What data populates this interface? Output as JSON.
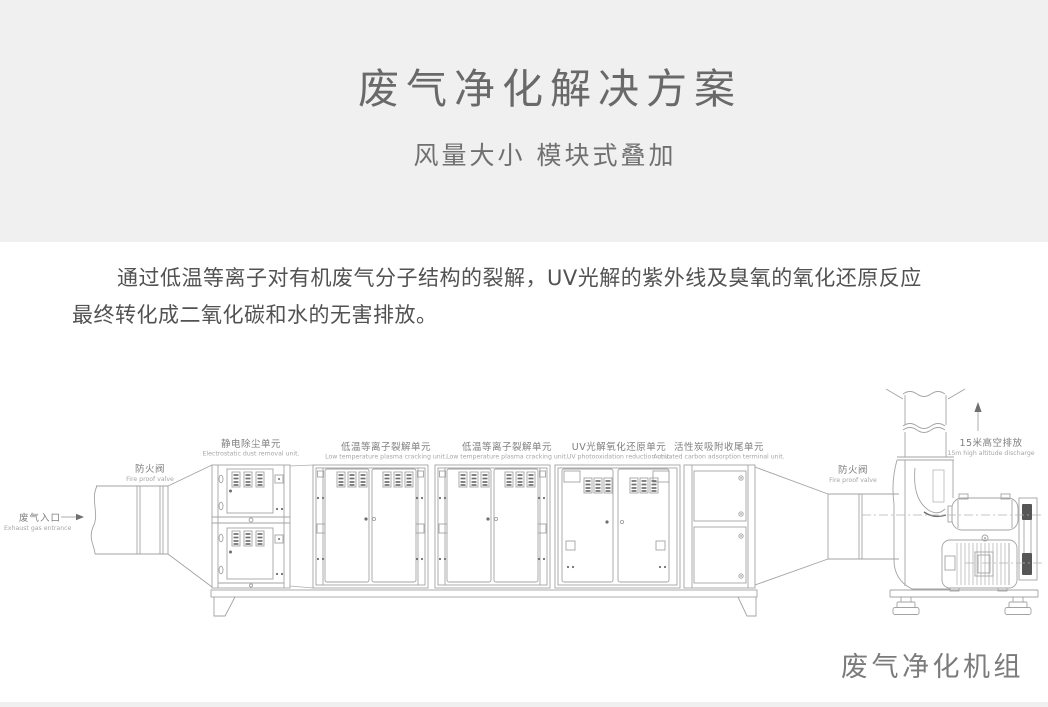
{
  "header": {
    "title": "废气净化解决方案",
    "subtitle": "风量大小 模块式叠加"
  },
  "intro": {
    "line1": "通过低温等离子对有机废气分子结构的裂解，UV光解的紫外线及臭氧的氧化还原反应",
    "line2": "最终转化成二氧化碳和水的无害排放。"
  },
  "diagram": {
    "inlet": {
      "zh": "废气入口",
      "en": "Exhaust gas entrance"
    },
    "fire_valve_left": {
      "zh": "防火阀",
      "en": "Fire proof valve"
    },
    "units": [
      {
        "zh": "静电除尘单元",
        "en": "Electrostatic dust removal unit."
      },
      {
        "zh": "低温等离子裂解单元",
        "en": "Low temperature plasma cracking unit."
      },
      {
        "zh": "低温等离子裂解单元",
        "en": "Low temperature plasma cracking unit."
      },
      {
        "zh": "UV光解氧化还原单元",
        "en": "UV photooxidation reduction unit."
      },
      {
        "zh": "活性炭吸附收尾单元",
        "en": "Activated carbon adsorption terminal unit."
      }
    ],
    "fire_valve_right": {
      "zh": "防火阀",
      "en": "Fire proof valve"
    },
    "discharge": {
      "zh": "15米高空排放",
      "en": "15m high altitude discharge"
    },
    "caption": "废气净化机组"
  },
  "colors": {
    "band": "#f0f0f1",
    "line": "#a3a3a3",
    "text_dark": "#525252"
  }
}
